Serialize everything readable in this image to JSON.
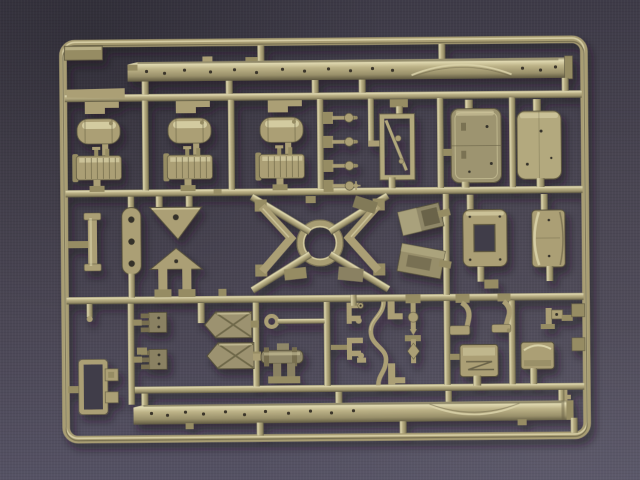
{
  "scene": {
    "subject": "injection-molded plastic model kit sprue photographed on fabric",
    "plastic_color_name": "olive-drab khaki",
    "background_name": "dark slate-purple woven cloth"
  },
  "colors": {
    "bg_top": "#3e3b48",
    "bg_mid": "#474350",
    "bg_low": "#555264",
    "plastic": "#ab9f74",
    "plastic_light": "#d9d2a8",
    "plastic_dark": "#6b6448",
    "plastic_deep": "#8a8162",
    "plastic_mid": "#968c64",
    "hole": "#35322a",
    "inner_bg": "#3f3c49"
  },
  "parts": [
    {
      "name": "chassis side rail",
      "count": 2
    },
    {
      "name": "smooth cylindrical fuel tank",
      "count": 3
    },
    {
      "name": "ribbed fuel tank",
      "count": 3
    },
    {
      "name": "stowage box",
      "count": 2
    },
    {
      "name": "frame with diagonal brace",
      "count": 1
    },
    {
      "name": "open rectangular frame",
      "count": 1
    },
    {
      "name": "curved cover plate",
      "count": 1
    },
    {
      "name": "V-shaped spring hanger",
      "count": 2
    },
    {
      "name": "triangular bracket",
      "count": 2
    },
    {
      "name": "cross-braced panel",
      "count": 2
    },
    {
      "name": "comb bracket",
      "count": 2
    },
    {
      "name": "grab handle",
      "count": 4
    },
    {
      "name": "seat base",
      "count": 2
    },
    {
      "name": "pedal lever",
      "count": 2
    },
    {
      "name": "winch assembly",
      "count": 1
    },
    {
      "name": "S-shaped pipe",
      "count": 1
    },
    {
      "name": "tie rod with eye",
      "count": 1
    },
    {
      "name": "ladder frame",
      "count": 1
    },
    {
      "name": "small fittings and gates",
      "count": 24
    }
  ]
}
